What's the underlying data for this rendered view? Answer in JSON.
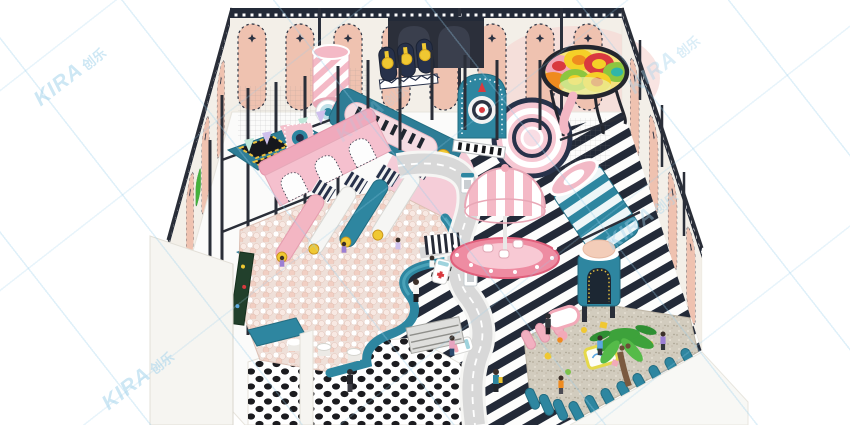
{
  "meta": {
    "alt": "3D isometric render of a kids indoor playground park with ball pit, slides, carousel, toy road, trampolines and sand pit",
    "scene_type": "indoor-playground-3d-render"
  },
  "watermark": {
    "latin": "KIRA",
    "cjk": "创乐",
    "color": "#a5d4ec"
  },
  "palette": {
    "teal": "#2e86a0",
    "tealDeep": "#236d82",
    "navy": "#232a38",
    "frameDark": "#2a2e38",
    "pink": "#f3b7c4",
    "pinkDeep": "#ee8ca2",
    "blush": "#f5cdd8",
    "salmon": "#efc2b0",
    "cream": "#f3efe8",
    "floorWhite": "#fcfcfb",
    "road": "#d8d8d8",
    "sand": "#d2ccbe",
    "yellow": "#f0c832",
    "red": "#d93a3f",
    "orange": "#ef8b1f",
    "green": "#45b13c",
    "ballPit": "#efe0d9",
    "wm": "#a5d4ec"
  },
  "elements": [
    {
      "id": "back-wall",
      "desc": "cream wall, navy trim, pink arch panels with stars"
    },
    {
      "id": "left-wall",
      "desc": "side wall with pink arch panels"
    },
    {
      "id": "right-wall",
      "desc": "side wall with pink arch panels"
    },
    {
      "id": "striped-floor",
      "desc": "navy and white diagonal striped floor"
    },
    {
      "id": "dotted-floor",
      "desc": "white floor with black dots"
    },
    {
      "id": "ball-pit",
      "desc": "white and pink ball pool with teal curved wall"
    },
    {
      "id": "slide-lanes",
      "desc": "four slides ending in ball pit with coin targets"
    },
    {
      "id": "arch-bridge-slide",
      "desc": "pink slide structure with white arches"
    },
    {
      "id": "trampoline-deck",
      "desc": "black trampolines with yellow trim on teal deck"
    },
    {
      "id": "candy-roller-tube",
      "desc": "pink and white striped rolling tube"
    },
    {
      "id": "medal-boards",
      "desc": "three navy boards with gold medals"
    },
    {
      "id": "piano-slide",
      "desc": "teal slope with pink piano capsule"
    },
    {
      "id": "target-arch",
      "desc": "teal arch with dart target and rocket"
    },
    {
      "id": "spiral-slide",
      "desc": "pink spiral slide seen from above"
    },
    {
      "id": "rainbow-bowl",
      "desc": "colorful petal climbing bowl in black ring"
    },
    {
      "id": "striped-roller",
      "desc": "large teal and white striped roller"
    },
    {
      "id": "dome-tower",
      "desc": "teal tower with peach dome and arch door"
    },
    {
      "id": "carousel",
      "desc": "pink striped dome carousel on scalloped base"
    },
    {
      "id": "toy-road",
      "desc": "grey toy road with dashed line, zebra crossing, ambulance and car"
    },
    {
      "id": "gas-pumps",
      "desc": "two white and teal toy fuel pumps"
    },
    {
      "id": "sand-pit",
      "desc": "sand area with palm tree, toys and tables"
    },
    {
      "id": "scalloped-fence",
      "desc": "teal and pink rounded fence posts"
    },
    {
      "id": "shoe-rack",
      "desc": "grey shoe shelf"
    },
    {
      "id": "people",
      "desc": "children and adults playing"
    }
  ]
}
